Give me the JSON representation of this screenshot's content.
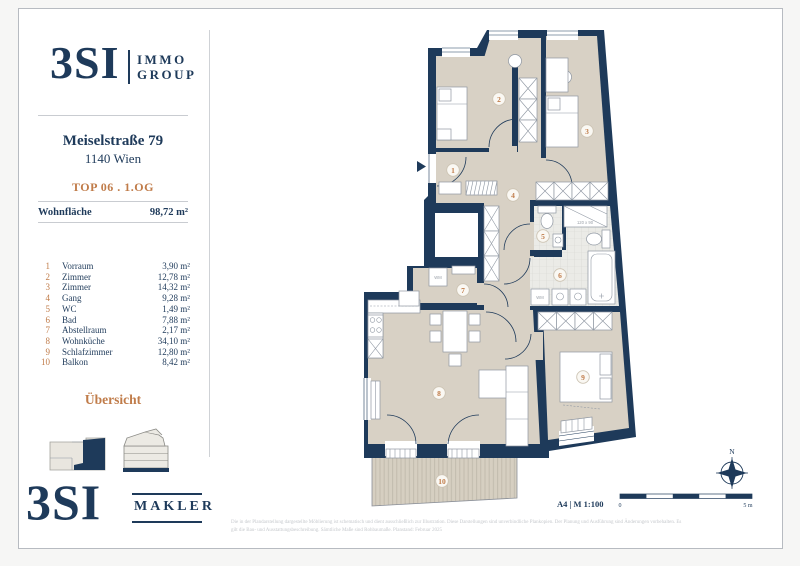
{
  "colors": {
    "navy": "#1e3a5a",
    "orange": "#c07c4a",
    "floor_beige": "#d8d1c5"
  },
  "sidebar": {
    "brand_top": {
      "name": "3SI",
      "line1": "IMMO",
      "line2": "GROUP"
    },
    "address_line1": "Meiselstraße 79",
    "address_line2": "1140 Wien",
    "unit": "TOP 06 . 1.OG",
    "area_label": "Wohnfläche",
    "area_value": "98,72 m²",
    "rooms": [
      {
        "num": "1",
        "name": "Vorraum",
        "area": "3,90 m²"
      },
      {
        "num": "2",
        "name": "Zimmer",
        "area": "12,78 m²"
      },
      {
        "num": "3",
        "name": "Zimmer",
        "area": "14,32 m²"
      },
      {
        "num": "4",
        "name": "Gang",
        "area": "9,28 m²"
      },
      {
        "num": "5",
        "name": "WC",
        "area": "1,49 m²"
      },
      {
        "num": "6",
        "name": "Bad",
        "area": "7,88 m²"
      },
      {
        "num": "7",
        "name": "Abstellraum",
        "area": "2,17 m²"
      },
      {
        "num": "8",
        "name": "Wohnküche",
        "area": "34,10 m²"
      },
      {
        "num": "9",
        "name": "Schlafzimmer",
        "area": "12,80 m²"
      },
      {
        "num": "10",
        "name": "Balkon",
        "area": "8,42 m²"
      }
    ],
    "overview_label": "Übersicht",
    "brand_bottom": {
      "name": "3SI",
      "label": "MAKLER"
    }
  },
  "plan": {
    "labels": {
      "r1": "1",
      "r2": "2",
      "r3": "3",
      "r4": "4",
      "r5": "5",
      "r6": "6",
      "r7": "7",
      "r8": "8",
      "r9": "9",
      "r10": "10"
    },
    "annotations": {
      "shower_size": "120 x 90",
      "wm": "WM"
    },
    "scale": {
      "format": "A4 | M 1:100",
      "zero": "0",
      "max": "5 m",
      "north": "N"
    }
  },
  "footer": {
    "line1": "Die in der Plandarstellung dargestellte Möblierung ist schematisch und dient ausschließlich zur Illustration. Diese Darstellungen sind unverbindliche Plankopien. Der Planung und Ausführung sind Änderungen vorbehalten. Es",
    "line2": "gilt die Bau- und Ausstattungsbeschreibung. Sämtliche Maße sind Rohbaumaße. Planstand: Februar 2025"
  }
}
